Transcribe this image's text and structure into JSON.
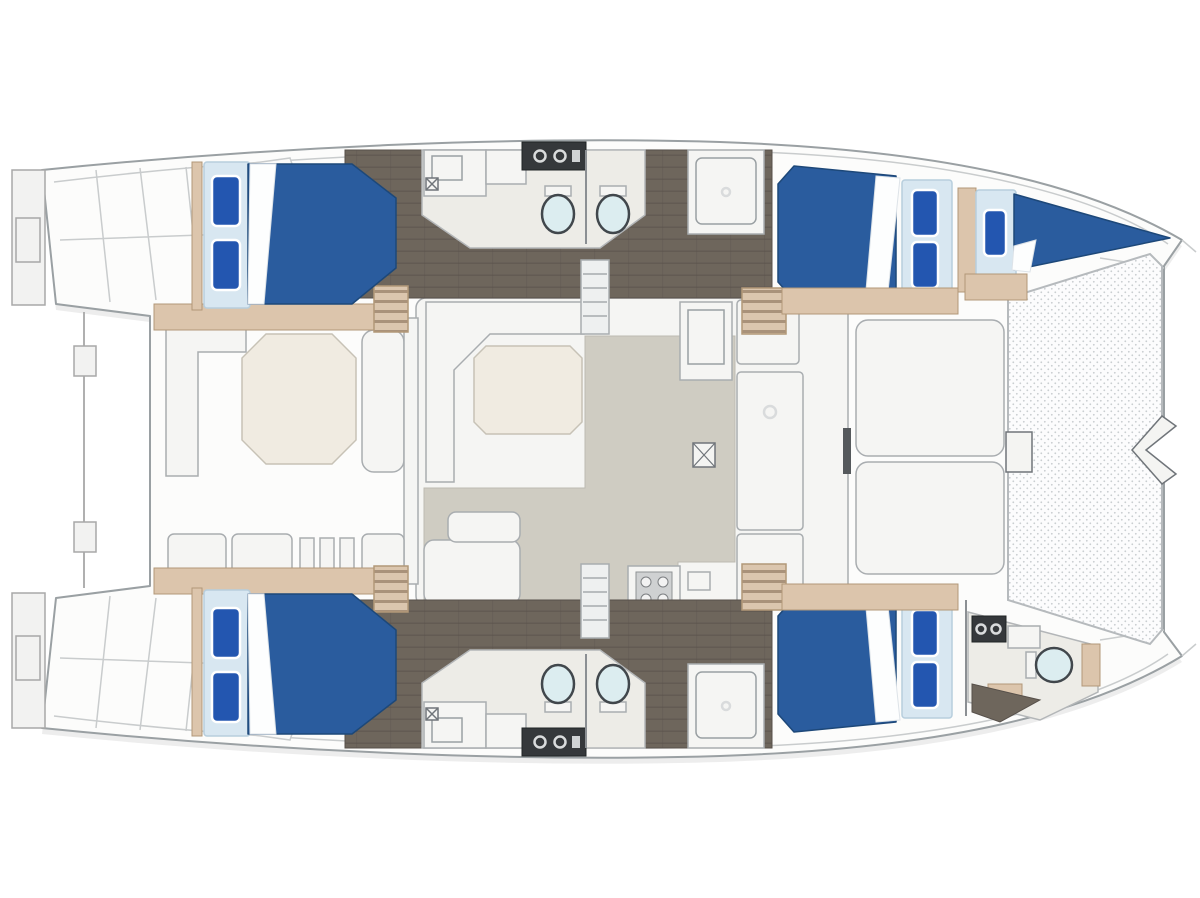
{
  "diagram": {
    "title": "Catamaran layout plan — top view, bow to the right",
    "type": "yacht-floor-plan",
    "bow_direction": "right",
    "stern_direction": "left"
  },
  "areas": {
    "aft_deck": {
      "label": "Aft cockpit",
      "items": [
        "octagonal cockpit table",
        "L-shaped bench",
        "side bench",
        "stern locker row",
        "transom steps port",
        "transom steps starboard",
        "swim platforms",
        "davit cable"
      ]
    },
    "saloon": {
      "label": "Saloon and galley",
      "items": [
        "U-shaped sofa",
        "saloon table",
        "chaise seat",
        "fridge",
        "galley counters",
        "stove",
        "floor hatch",
        "entry steps"
      ]
    },
    "foredeck": {
      "label": "Forward cockpit and bow",
      "items": [
        "forward bench aft",
        "forward bench fore",
        "access door",
        "trampoline",
        "bow roller chevron"
      ]
    },
    "port_hull": {
      "label": "Port hull (top)",
      "items": [
        "aft double cabin",
        "mid bathroom with two toilets",
        "shower",
        "companionway stairs",
        "forward double cabin",
        "forepeak single berth"
      ]
    },
    "starboard_hull": {
      "label": "Starboard hull (bottom)",
      "items": [
        "aft double cabin",
        "mid bathroom with two toilets",
        "shower",
        "companionway stairs",
        "forward double cabin",
        "forward bow head with toilet and vanity"
      ]
    }
  },
  "features": {
    "double_cabins": 4,
    "single_berths": 1,
    "toilets": 5,
    "showers": 2,
    "tables": 2,
    "trampolines": 1,
    "swim_platforms": 2
  },
  "colors": {
    "background": "#ffffff",
    "hull_fill": "#fcfcfb",
    "hull_outline": "#9aa0a3",
    "deck_line": "#c9cccd",
    "shadow": "#e8e9e9",
    "floor_dark": "#6e665c",
    "wood_tan": "#dcc5ac",
    "wood_tan_stroke": "#b29878",
    "bed_blue": "#2a5c9e",
    "bed_blue_dark": "#1d4879",
    "pillow_blue": "#2356b0",
    "bed_frame": "#d8e7f1",
    "bed_frame_stroke": "#b7cedd",
    "counter_white": "#f5f5f3",
    "outline_gray": "#a9adb0",
    "island_floor": "#edece7",
    "saloon_floor": "#cfccc2",
    "table_beige": "#f0ebe1",
    "toilet_fill": "#dcedf0",
    "toilet_stroke": "#41474c",
    "dark_fixture": "#35383b",
    "mesh_dot": "#c9cdd0"
  }
}
